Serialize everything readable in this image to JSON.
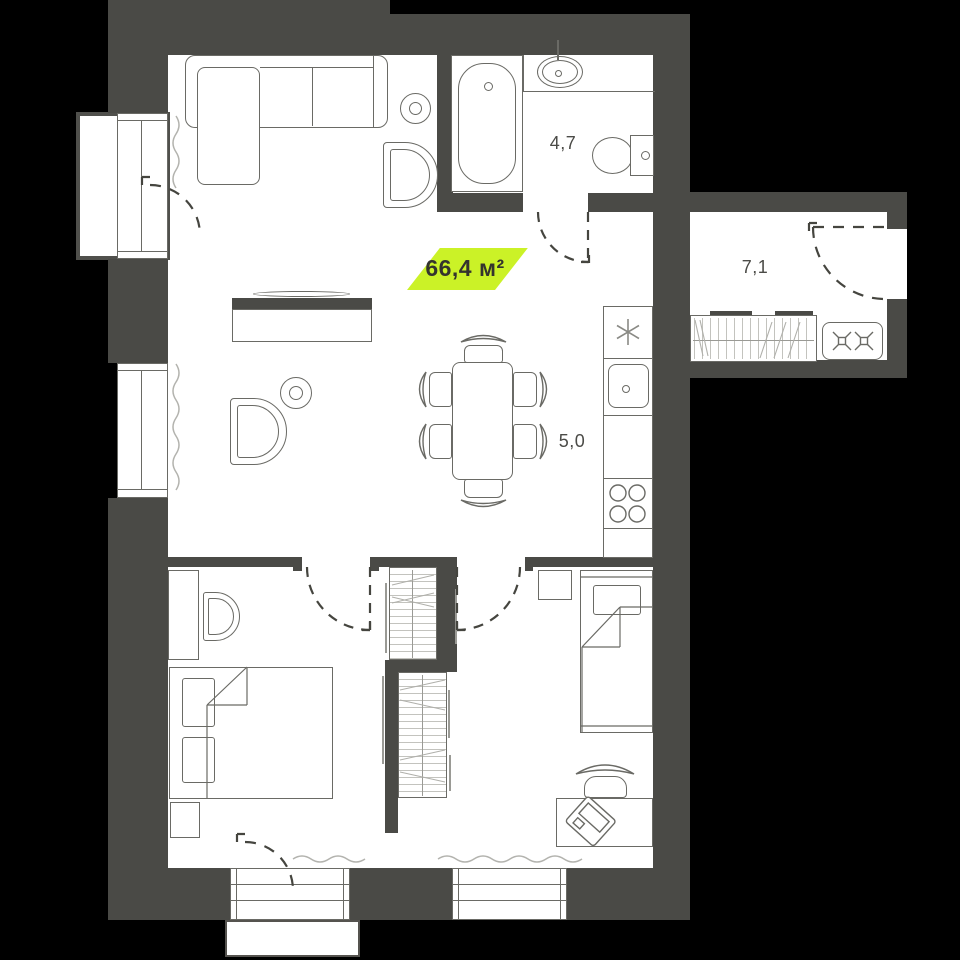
{
  "title": "Apartment floor plan",
  "badge": {
    "total_area": "66,4 м²"
  },
  "rooms": {
    "bathroom": {
      "area": "4,7"
    },
    "hallway": {
      "area": "7,1"
    },
    "kitchen": {
      "area": "5,0"
    }
  },
  "icons": [
    "bathtub-icon",
    "bathroom-sink-icon",
    "toilet-icon",
    "fridge-snowflake-icon",
    "kitchen-sink-icon",
    "stove-burners-icon",
    "hob-2-burner-icon",
    "wardrobe-hangers-icon",
    "wardrobe-shelves-icon",
    "sofa-icon",
    "armchair-icon",
    "tv-stand-icon",
    "dining-table-icon",
    "chair-icon",
    "double-bed-icon",
    "single-bed-icon",
    "desk-icon",
    "laptop-icon",
    "nightstand-icon",
    "radiator-squiggle-icon",
    "door-swing-icon",
    "window-icon",
    "balcony-icon",
    "side-table-icon"
  ],
  "colors": {
    "wall": "#4a4a46",
    "floor": "#ffffff",
    "background": "#000000",
    "outline": "#6a6a65",
    "light_line": "#b3b3ae",
    "accent": "#cbf227",
    "door_line": "#45453f",
    "label_text": "#4b4b47"
  }
}
